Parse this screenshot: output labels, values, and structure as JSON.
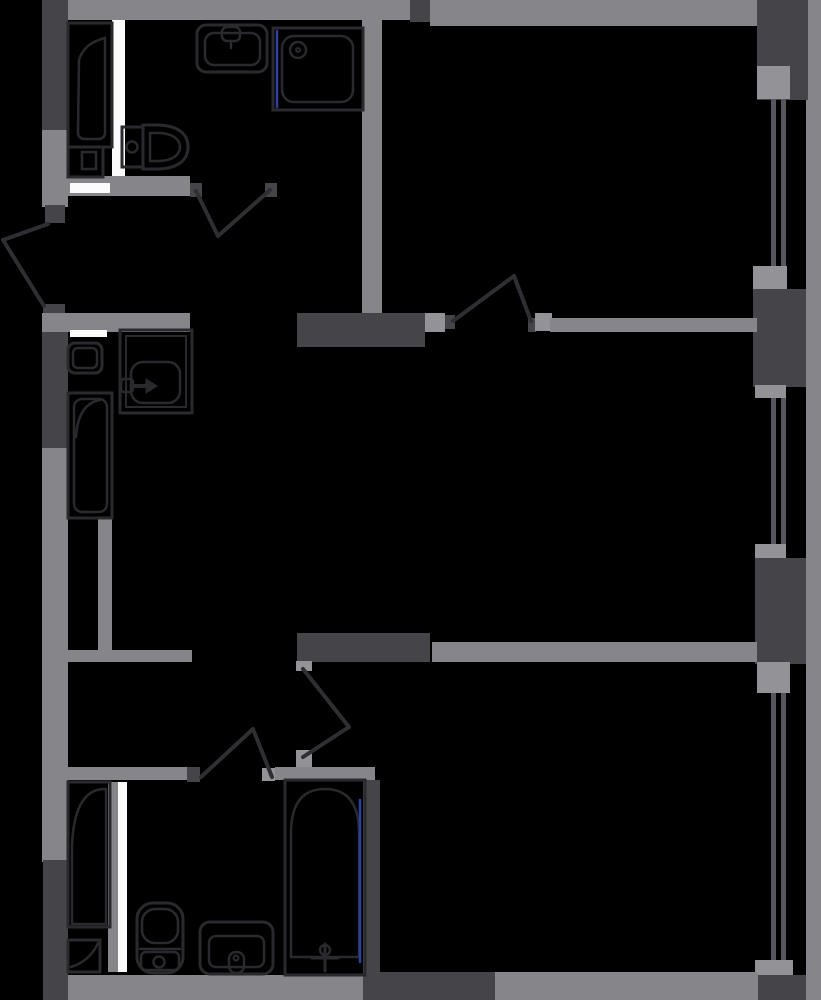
{
  "title": "apartment-floor-plan",
  "palette": {
    "bg": "#000000",
    "wall_light": "#85858a",
    "wall_dark": "#454549",
    "sill": "#929297",
    "white": "#fbfbfb",
    "glass": "#56565c",
    "fixture": "#2a2a2e",
    "door": "#2e2e33",
    "glazing_blue": "#2e3f9f"
  },
  "canvas": {
    "w": 821,
    "h": 1000
  },
  "walls": [
    {
      "n": "top-wall-left",
      "x": 68,
      "y": 0,
      "w": 342,
      "h": 20,
      "c": "wall_light"
    },
    {
      "n": "top-wall-column",
      "x": 410,
      "y": 0,
      "w": 20,
      "h": 22,
      "c": "wall_dark"
    },
    {
      "n": "top-wall-right",
      "x": 430,
      "y": 0,
      "w": 328,
      "h": 26,
      "c": "wall_light"
    },
    {
      "n": "right-outer-strip",
      "x": 806,
      "y": 0,
      "w": 15,
      "h": 1000,
      "c": "wall_light"
    },
    {
      "n": "right-wall-seg-1",
      "x": 757,
      "y": 0,
      "w": 51,
      "h": 100,
      "c": "wall_dark"
    },
    {
      "n": "window-sill-1",
      "x": 757,
      "y": 66,
      "w": 33,
      "h": 33,
      "c": "sill"
    },
    {
      "n": "window-1-glass-a",
      "x": 771,
      "y": 99,
      "w": 5,
      "h": 171,
      "c": "glass"
    },
    {
      "n": "window-1-glass-b",
      "x": 781,
      "y": 99,
      "w": 5,
      "h": 171,
      "c": "glass"
    },
    {
      "n": "window-sill-2",
      "x": 753,
      "y": 266,
      "w": 34,
      "h": 23,
      "c": "sill"
    },
    {
      "n": "right-wall-seg-2",
      "x": 753,
      "y": 289,
      "w": 53,
      "h": 98,
      "c": "wall_dark"
    },
    {
      "n": "window-sill-3",
      "x": 755,
      "y": 385,
      "w": 31,
      "h": 13,
      "c": "sill"
    },
    {
      "n": "window-2-glass-a",
      "x": 771,
      "y": 398,
      "w": 5,
      "h": 146,
      "c": "glass"
    },
    {
      "n": "window-2-glass-b",
      "x": 781,
      "y": 398,
      "w": 5,
      "h": 146,
      "c": "glass"
    },
    {
      "n": "window-sill-4",
      "x": 755,
      "y": 544,
      "w": 31,
      "h": 14,
      "c": "sill"
    },
    {
      "n": "right-wall-seg-3",
      "x": 755,
      "y": 558,
      "w": 51,
      "h": 106,
      "c": "wall_dark"
    },
    {
      "n": "window-sill-5",
      "x": 757,
      "y": 662,
      "w": 33,
      "h": 31,
      "c": "sill"
    },
    {
      "n": "window-3-glass-a",
      "x": 771,
      "y": 693,
      "w": 5,
      "h": 268,
      "c": "glass"
    },
    {
      "n": "window-3-glass-b",
      "x": 781,
      "y": 693,
      "w": 5,
      "h": 268,
      "c": "glass"
    },
    {
      "n": "window-sill-6",
      "x": 755,
      "y": 960,
      "w": 38,
      "h": 17,
      "c": "sill"
    },
    {
      "n": "right-wall-seg-4",
      "x": 755,
      "y": 975,
      "w": 51,
      "h": 25,
      "c": "wall_dark"
    },
    {
      "n": "left-wall-seg-1",
      "x": 42,
      "y": 0,
      "w": 26,
      "h": 130,
      "c": "wall_dark"
    },
    {
      "n": "left-wall-seg-2",
      "x": 42,
      "y": 130,
      "w": 26,
      "h": 77,
      "c": "wall_light"
    },
    {
      "n": "entry-door-jamb-top",
      "x": 45,
      "y": 205,
      "w": 20,
      "h": 18,
      "c": "wall_dark"
    },
    {
      "n": "entry-door-jamb-bottom",
      "x": 43,
      "y": 304,
      "w": 22,
      "h": 18,
      "c": "wall_dark"
    },
    {
      "n": "left-wall-seg-3",
      "x": 42,
      "y": 322,
      "w": 26,
      "h": 126,
      "c": "wall_dark"
    },
    {
      "n": "left-wall-seg-4",
      "x": 42,
      "y": 448,
      "w": 26,
      "h": 414,
      "c": "wall_light"
    },
    {
      "n": "left-wall-seg-5",
      "x": 43,
      "y": 860,
      "w": 25,
      "h": 140,
      "c": "wall_dark"
    },
    {
      "n": "bath1-right-wall",
      "x": 362,
      "y": 20,
      "w": 20,
      "h": 297,
      "c": "wall_light"
    },
    {
      "n": "bath1-duct-strip",
      "x": 112,
      "y": 20,
      "w": 13,
      "h": 157,
      "c": "white"
    },
    {
      "n": "bath1-bottom-wall",
      "x": 42,
      "y": 176,
      "w": 148,
      "h": 20,
      "c": "wall_light"
    },
    {
      "n": "bath1-bottom-white",
      "x": 70,
      "y": 183,
      "w": 40,
      "h": 10,
      "c": "white"
    },
    {
      "n": "bath1-door-jamb-left",
      "x": 190,
      "y": 183,
      "w": 12,
      "h": 14,
      "c": "wall_dark"
    },
    {
      "n": "bath1-door-jamb-right",
      "x": 265,
      "y": 183,
      "w": 12,
      "h": 14,
      "c": "wall_dark"
    },
    {
      "n": "mid-wall-dark",
      "x": 297,
      "y": 313,
      "w": 128,
      "h": 34,
      "c": "wall_dark"
    },
    {
      "n": "mid-door-jamb-left",
      "x": 425,
      "y": 313,
      "w": 20,
      "h": 19,
      "c": "sill"
    },
    {
      "n": "mid-door-hinge-left",
      "x": 445,
      "y": 315,
      "w": 10,
      "h": 14,
      "c": "wall_dark"
    },
    {
      "n": "mid-door-hinge-right",
      "x": 528,
      "y": 318,
      "w": 8,
      "h": 14,
      "c": "wall_dark"
    },
    {
      "n": "mid-door-jamb-right",
      "x": 535,
      "y": 313,
      "w": 17,
      "h": 18,
      "c": "sill"
    },
    {
      "n": "mid-wall-right",
      "x": 550,
      "y": 318,
      "w": 207,
      "h": 14,
      "c": "wall_light"
    },
    {
      "n": "bath2-top-wall",
      "x": 42,
      "y": 313,
      "w": 148,
      "h": 19,
      "c": "wall_light"
    },
    {
      "n": "bath2-top-white",
      "x": 70,
      "y": 330,
      "w": 37,
      "h": 7,
      "c": "white"
    },
    {
      "n": "closet-wall-vertical",
      "x": 98,
      "y": 518,
      "w": 14,
      "h": 132,
      "c": "wall_light"
    },
    {
      "n": "closet-wall-horizontal",
      "x": 66,
      "y": 650,
      "w": 126,
      "h": 12,
      "c": "wall_light"
    },
    {
      "n": "lower-mid-wall-dark",
      "x": 297,
      "y": 633,
      "w": 133,
      "h": 29,
      "c": "wall_dark"
    },
    {
      "n": "lower-wall-right",
      "x": 432,
      "y": 642,
      "w": 325,
      "h": 20,
      "c": "wall_light"
    },
    {
      "n": "room3-door-jamb-top",
      "x": 296,
      "y": 661,
      "w": 16,
      "h": 10,
      "c": "sill"
    },
    {
      "n": "room3-door-jamb-bottom",
      "x": 296,
      "y": 750,
      "w": 16,
      "h": 20,
      "c": "sill"
    },
    {
      "n": "bath3-top-wall-left",
      "x": 42,
      "y": 767,
      "w": 145,
      "h": 13,
      "c": "wall_light"
    },
    {
      "n": "bath3-door-jamb-left",
      "x": 187,
      "y": 767,
      "w": 13,
      "h": 15,
      "c": "wall_dark"
    },
    {
      "n": "bath3-door-jamb-right",
      "x": 262,
      "y": 768,
      "w": 13,
      "h": 13,
      "c": "sill"
    },
    {
      "n": "bath3-top-wall-right",
      "x": 275,
      "y": 767,
      "w": 100,
      "h": 13,
      "c": "wall_light"
    },
    {
      "n": "bath3-right-wall",
      "x": 363,
      "y": 780,
      "w": 17,
      "h": 195,
      "c": "wall_dark"
    },
    {
      "n": "bath3-wall-strip",
      "x": 108,
      "y": 782,
      "w": 10,
      "h": 190,
      "c": "wall_light"
    },
    {
      "n": "bath3-duct-strip",
      "x": 118,
      "y": 782,
      "w": 9,
      "h": 190,
      "c": "white"
    },
    {
      "n": "bottom-wall-left",
      "x": 68,
      "y": 975,
      "w": 296,
      "h": 25,
      "c": "wall_light"
    },
    {
      "n": "bottom-wall-mid",
      "x": 363,
      "y": 972,
      "w": 132,
      "h": 28,
      "c": "wall_dark"
    },
    {
      "n": "bottom-wall-right",
      "x": 495,
      "y": 972,
      "w": 263,
      "h": 28,
      "c": "wall_light"
    }
  ],
  "fixtures": [
    {
      "n": "bathtub-1-outline",
      "t": "rect",
      "x": 68,
      "y": 23,
      "w": 44,
      "h": 124,
      "sw": 3
    },
    {
      "n": "bathtub-1-basin",
      "t": "path",
      "d": "M105,38 Q84,43 79,60 L78,132 Q78,139 85,139 L98,139 Q105,139 105,132 Z",
      "sw": 2.5
    },
    {
      "n": "washer-1-outline",
      "t": "rect",
      "x": 68,
      "y": 147,
      "w": 35,
      "h": 30,
      "sw": 3
    },
    {
      "n": "washer-1-inner",
      "t": "rect",
      "x": 82,
      "y": 152,
      "w": 14,
      "h": 17,
      "sw": 2.5
    },
    {
      "n": "toilet-1-tank",
      "t": "rect",
      "x": 122,
      "y": 127,
      "w": 21,
      "h": 40,
      "sw": 3
    },
    {
      "n": "toilet-1-bowl",
      "t": "path",
      "d": "M143,125 L156,125 C178,125 188,134 188,147 C188,160 178,169 156,169 L143,169 Z",
      "sw": 3
    },
    {
      "n": "toilet-1-bowl-inner",
      "t": "path",
      "d": "M150,133 L158,133 C172,133 180,139 180,147 C180,155 172,161 158,161 L150,161 Z",
      "sw": 2.5
    },
    {
      "n": "toilet-1-button",
      "t": "circle",
      "cx": 132,
      "cy": 147,
      "r": 5.5,
      "sw": 2.5
    },
    {
      "n": "sink-1-outline",
      "t": "rect",
      "x": 197,
      "y": 25,
      "w": 70,
      "h": 47,
      "rx": 9,
      "sw": 3
    },
    {
      "n": "sink-1-basin",
      "t": "rect",
      "x": 205,
      "y": 33,
      "w": 55,
      "h": 32,
      "rx": 9,
      "sw": 2.5
    },
    {
      "n": "sink-1-faucet",
      "t": "rect",
      "x": 222,
      "y": 27,
      "w": 18,
      "h": 14,
      "rx": 5,
      "sw": 2.5
    },
    {
      "n": "sink-1-spout",
      "t": "line",
      "x1": 231,
      "y1": 41,
      "x2": 231,
      "y2": 48,
      "sw": 2.5
    },
    {
      "n": "shower-1-outline",
      "t": "rect",
      "x": 273,
      "y": 28,
      "w": 90,
      "h": 82,
      "sw": 3
    },
    {
      "n": "shower-1-tray",
      "t": "rect",
      "x": 282,
      "y": 36,
      "w": 71,
      "h": 66,
      "rx": 12,
      "sw": 2.5
    },
    {
      "n": "shower-1-drain",
      "t": "circle",
      "cx": 298,
      "cy": 50,
      "r": 8,
      "sw": 2.5
    },
    {
      "n": "shower-1-drain-dot",
      "t": "circle",
      "cx": 298,
      "cy": 50,
      "r": 2,
      "sw": 2
    },
    {
      "n": "shower-1-glass",
      "t": "line",
      "x1": 277,
      "y1": 31,
      "x2": 277,
      "y2": 107,
      "sc": "glazing_blue",
      "sw": 2.5
    },
    {
      "n": "washer-2-outline",
      "t": "rect",
      "x": 68,
      "y": 343,
      "w": 34,
      "h": 30,
      "rx": 7,
      "sw": 3
    },
    {
      "n": "washer-2-inner",
      "t": "rect",
      "x": 73,
      "y": 348,
      "w": 24,
      "h": 20,
      "rx": 5,
      "sw": 2.5
    },
    {
      "n": "vanity-2-outline",
      "t": "rect",
      "x": 120,
      "y": 330,
      "w": 72,
      "h": 83,
      "sw": 3
    },
    {
      "n": "vanity-2-inner",
      "t": "rect",
      "x": 126,
      "y": 336,
      "w": 60,
      "h": 71,
      "sw": 2
    },
    {
      "n": "vanity-2-basin",
      "t": "rect",
      "x": 131,
      "y": 362,
      "w": 49,
      "h": 41,
      "rx": 12,
      "sw": 2.5
    },
    {
      "n": "vanity-2-tap",
      "t": "rect",
      "x": 121,
      "y": 379,
      "w": 12,
      "h": 13,
      "rx": 3,
      "sw": 2.5
    },
    {
      "n": "vanity-2-tap-stem",
      "t": "line",
      "x1": 134,
      "y1": 386,
      "x2": 147,
      "y2": 386,
      "sw": 4
    },
    {
      "n": "vanity-2-tap-arrow",
      "t": "path",
      "d": "M146,379 L157,386 L146,393 Z",
      "f": "fixture",
      "sw": 1
    },
    {
      "n": "bathtub-2-outline",
      "t": "rect",
      "x": 68,
      "y": 393,
      "w": 44,
      "h": 125,
      "sw": 3
    },
    {
      "n": "bathtub-2-basin",
      "t": "rect",
      "x": 74,
      "y": 399,
      "w": 33,
      "h": 113,
      "rx": 8,
      "sw": 2.5
    },
    {
      "n": "bathtub-2-curve",
      "t": "path",
      "d": "M76,437 Q78,404 100,400",
      "sw": 2.5
    },
    {
      "n": "bathtub-3-outline",
      "t": "rect",
      "x": 68,
      "y": 782,
      "w": 42,
      "h": 145,
      "sw": 3
    },
    {
      "n": "bathtub-3-basin",
      "t": "path",
      "d": "M72,924 L72,846 Q74,791 103,789 L106,789 L106,924 Z",
      "sw": 2.5
    },
    {
      "n": "corner-sink-3-outline",
      "t": "rect",
      "x": 68,
      "y": 940,
      "w": 32,
      "h": 32,
      "sw": 3
    },
    {
      "n": "corner-sink-3-arc",
      "t": "path",
      "d": "M71,967 Q90,961 98,943",
      "sw": 2.5
    },
    {
      "n": "toilet-3-outline",
      "t": "rect",
      "x": 137,
      "y": 903,
      "w": 46,
      "h": 70,
      "rx": 16,
      "sw": 3
    },
    {
      "n": "toilet-3-inner",
      "t": "rect",
      "x": 142,
      "y": 909,
      "w": 36,
      "h": 34,
      "rx": 13,
      "sw": 2.5
    },
    {
      "n": "toilet-3-divider",
      "t": "line",
      "x1": 140,
      "y1": 949,
      "x2": 180,
      "y2": 949,
      "sw": 2.5
    },
    {
      "n": "toilet-3-cistern",
      "t": "rect",
      "x": 141,
      "y": 952,
      "w": 38,
      "h": 18,
      "rx": 5,
      "sw": 2.5
    },
    {
      "n": "toilet-3-button",
      "t": "circle",
      "cx": 159,
      "cy": 962,
      "r": 5.5,
      "sw": 2.5
    },
    {
      "n": "sink-3-outline",
      "t": "rect",
      "x": 200,
      "y": 922,
      "w": 73,
      "h": 52,
      "rx": 10,
      "sw": 3
    },
    {
      "n": "sink-3-basin",
      "t": "rect",
      "x": 209,
      "y": 936,
      "w": 55,
      "h": 31,
      "rx": 7,
      "sw": 2.5
    },
    {
      "n": "sink-3-faucet",
      "t": "rect",
      "x": 229,
      "y": 952,
      "w": 15,
      "h": 21,
      "rx": 7,
      "sw": 2.5
    },
    {
      "n": "sink-3-faucet-dot",
      "t": "circle",
      "cx": 236,
      "cy": 958,
      "r": 2.5,
      "sw": 2
    },
    {
      "n": "bathtub-4-outline",
      "t": "rect",
      "x": 285,
      "y": 780,
      "w": 80,
      "h": 195,
      "sw": 3
    },
    {
      "n": "bathtub-4-basin",
      "t": "path",
      "d": "M291,957 L291,833 Q291,789 325,789 Q359,789 359,833 L359,957 Z",
      "sw": 2.5
    },
    {
      "n": "bathtub-4-tap-h",
      "t": "line",
      "x1": 312,
      "y1": 958,
      "x2": 338,
      "y2": 958,
      "sw": 3
    },
    {
      "n": "bathtub-4-tap-v",
      "t": "line",
      "x1": 325,
      "y1": 944,
      "x2": 325,
      "y2": 971,
      "sw": 3
    },
    {
      "n": "bathtub-4-tap-knob",
      "t": "circle",
      "cx": 325,
      "cy": 950,
      "r": 5,
      "sw": 2.5
    },
    {
      "n": "bathtub-4-glass",
      "t": "line",
      "x1": 360,
      "y1": 800,
      "x2": 360,
      "y2": 962,
      "sc": "glazing_blue",
      "sw": 2.5
    }
  ],
  "doors": [
    {
      "n": "entry-door-leaf",
      "x1": 48,
      "y1": 224,
      "x2": 3,
      "y2": 240
    },
    {
      "n": "entry-door-swing",
      "x1": 3,
      "y1": 240,
      "x2": 44,
      "y2": 306
    },
    {
      "n": "bath1-door-leaf",
      "x1": 196,
      "y1": 191,
      "x2": 218,
      "y2": 236
    },
    {
      "n": "bath1-door-swing",
      "x1": 218,
      "y1": 236,
      "x2": 270,
      "y2": 190
    },
    {
      "n": "mid-door-leaf",
      "x1": 453,
      "y1": 321,
      "x2": 514,
      "y2": 276
    },
    {
      "n": "mid-door-swing",
      "x1": 514,
      "y1": 276,
      "x2": 531,
      "y2": 321
    },
    {
      "n": "room3-door-leaf",
      "x1": 303,
      "y1": 669,
      "x2": 349,
      "y2": 727
    },
    {
      "n": "room3-door-swing",
      "x1": 349,
      "y1": 727,
      "x2": 303,
      "y2": 757
    },
    {
      "n": "bath3-door-leaf",
      "x1": 201,
      "y1": 777,
      "x2": 253,
      "y2": 729
    },
    {
      "n": "bath3-door-swing",
      "x1": 253,
      "y1": 729,
      "x2": 272,
      "y2": 777
    }
  ]
}
